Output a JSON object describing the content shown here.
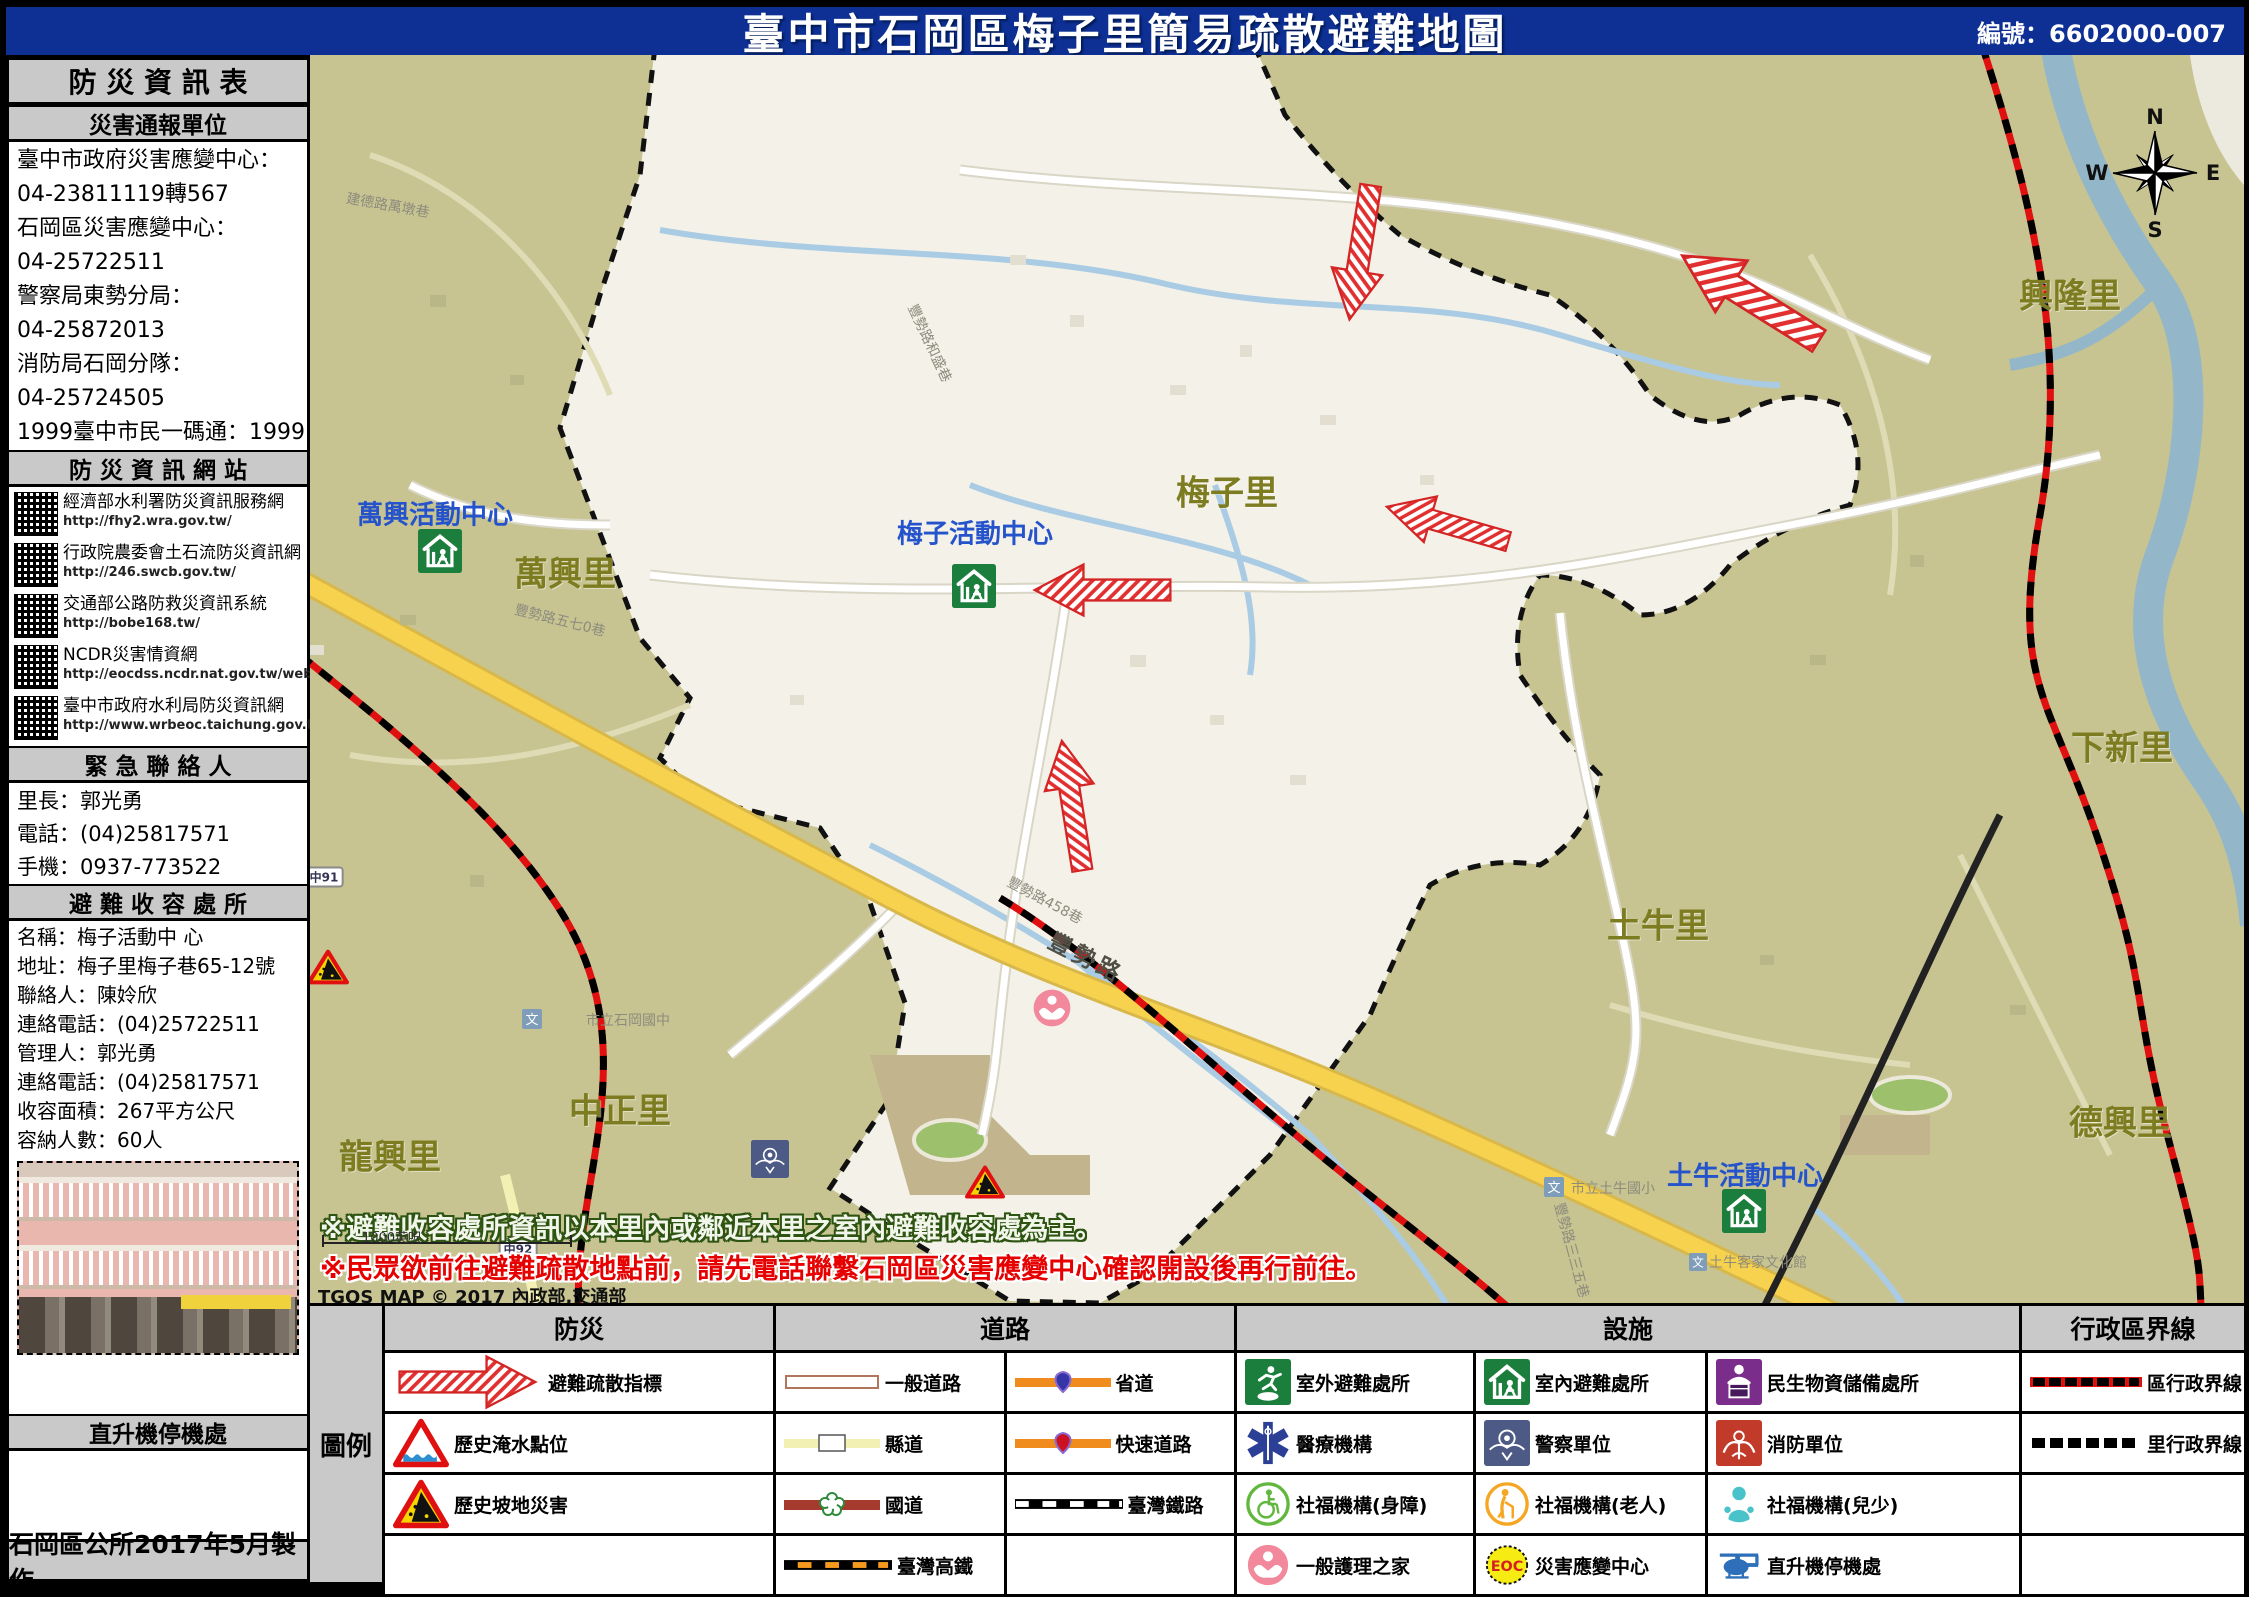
{
  "header": {
    "title": "臺中市石岡區梅子里簡易疏散避難地圖",
    "code": "編號：6602000-007"
  },
  "sidebar": {
    "title": "防 災 資 訊 表",
    "report_header": "災害通報單位",
    "report_lines": [
      {
        "t": "臺中市政府災害應變中心："
      },
      {
        "t": "04-23811119轉567"
      },
      {
        "t": "石岡區災害應變中心："
      },
      {
        "t": "04-25722511"
      },
      {
        "t": "警察局東勢分局："
      },
      {
        "t": "04-25872013"
      },
      {
        "t": "消防局石岡分隊："
      },
      {
        "t": "04-25724505"
      },
      {
        "t": "1999臺中市民一碼通：1999"
      }
    ],
    "web_header": "防 災 資 訊 網 站",
    "websites": [
      {
        "name": "經濟部水利署防災資訊服務網",
        "url": "http://fhy2.wra.gov.tw/"
      },
      {
        "name": "行政院農委會土石流防災資訊網",
        "url": "http://246.swcb.gov.tw/"
      },
      {
        "name": "交通部公路防救災資訊系統",
        "url": "http://bobe168.tw/"
      },
      {
        "name": "NCDR災害情資網",
        "url": "http://eocdss.ncdr.nat.gov.tw/web/"
      },
      {
        "name": "臺中市政府水利局防災資訊網",
        "url": "http://www.wrbeoc.taichung.gov.tw/"
      }
    ],
    "contact_header": "緊 急 聯 絡 人",
    "contact_lines": [
      {
        "t": "里長：郭光勇"
      },
      {
        "t": "電話：(04)25817571"
      },
      {
        "t": "手機：0937-773522"
      }
    ],
    "shelter_header": "避 難 收 容 處 所",
    "shelter_lines": [
      {
        "t": "名稱：梅子活動中 心"
      },
      {
        "t": "地址：梅子里梅子巷65-12號"
      },
      {
        "t": "聯絡人：陳姈欣"
      },
      {
        "t": "連絡電話：(04)25722511"
      },
      {
        "t": "管理人：郭光勇"
      },
      {
        "t": "連絡電話：(04)25817571"
      },
      {
        "t": "收容面積：267平方公尺"
      },
      {
        "t": "容納人數：60人"
      }
    ],
    "heliport_header": "直升機停機處",
    "footer": "石岡區公所2017年5月製作"
  },
  "map": {
    "notes": {
      "note1": "※避難收容處所資訊以本里內或鄰近本里之室內避難收容處為主。",
      "note2": "※民眾欲前往避難疏散地點前，請先電話聯繫石岡區災害應變中心確認開設後再行前往。",
      "credit": "TGOS MAP © 2017 內政部,交通部",
      "scale": "1000英呎"
    },
    "compass": [
      {
        "t": "N",
        "x": 1845,
        "y": 62
      },
      {
        "t": "E",
        "x": 1903,
        "y": 118
      },
      {
        "t": "S",
        "x": 1845,
        "y": 175
      },
      {
        "t": "W",
        "x": 1787,
        "y": 118
      }
    ],
    "labels": [
      {
        "text": "興隆里",
        "x": 1760,
        "y": 238,
        "cls": "lbl-village"
      },
      {
        "text": "下新里",
        "x": 1812,
        "y": 690,
        "cls": "lbl-village"
      },
      {
        "text": "德興里",
        "x": 1810,
        "y": 1065,
        "cls": "lbl-village"
      },
      {
        "text": "土牛里",
        "x": 1348,
        "y": 868,
        "cls": "lbl-village"
      },
      {
        "text": "梅子里",
        "x": 917,
        "y": 435,
        "cls": "lbl-village"
      },
      {
        "text": "萬興里",
        "x": 255,
        "y": 516,
        "cls": "lbl-village"
      },
      {
        "text": "中正里",
        "x": 310,
        "y": 1053,
        "cls": "lbl-village"
      },
      {
        "text": "龍興里",
        "x": 80,
        "y": 1099,
        "cls": "lbl-village"
      },
      {
        "text": "萬興活動中心",
        "x": 125,
        "y": 458,
        "cls": "lbl-shelter"
      },
      {
        "text": "梅子活動中心",
        "x": 665,
        "y": 477,
        "cls": "lbl-shelter"
      },
      {
        "text": "土牛活動中心",
        "x": 1435,
        "y": 1119,
        "cls": "lbl-shelter"
      },
      {
        "text": "豐勢路",
        "x": 777,
        "y": 901,
        "cls": "lbl-road",
        "rot": "27deg"
      },
      {
        "text": "市立石岡國中",
        "x": 318,
        "y": 965,
        "cls": "lbl-small"
      },
      {
        "text": "市立土牛國小",
        "x": 1303,
        "y": 1133,
        "cls": "lbl-small"
      },
      {
        "text": "土牛客家文化館",
        "x": 1448,
        "y": 1207,
        "cls": "lbl-small"
      },
      {
        "text": "豐勢路458巷",
        "x": 735,
        "y": 845,
        "cls": "lbl-small",
        "rot": "28deg"
      },
      {
        "text": "豐勢路五七0巷",
        "x": 250,
        "y": 565,
        "cls": "lbl-small",
        "rot": "14deg"
      },
      {
        "text": "豐勢路三三五巷",
        "x": 1262,
        "y": 1195,
        "cls": "lbl-small",
        "rot": "75deg"
      },
      {
        "text": "建德路萬墩巷",
        "x": 78,
        "y": 150,
        "cls": "lbl-small",
        "rot": "10deg"
      },
      {
        "text": "豐勢路和盛巷",
        "x": 620,
        "y": 288,
        "cls": "lbl-small",
        "rot": "65deg"
      }
    ],
    "icons": [
      {
        "icon": "sym-fac-indoor",
        "x": 130,
        "y": 496,
        "w": 44,
        "h": 44
      },
      {
        "icon": "sym-fac-indoor",
        "x": 664,
        "y": 531,
        "w": 44,
        "h": 44
      },
      {
        "icon": "sym-fac-indoor",
        "x": 1434,
        "y": 1156,
        "w": 44,
        "h": 44
      },
      {
        "icon": "sym-slope",
        "x": 18,
        "y": 912,
        "w": 42,
        "h": 40
      },
      {
        "icon": "sym-slope",
        "x": 675,
        "y": 1127,
        "w": 40,
        "h": 38
      },
      {
        "icon": "sym-fac-nursing",
        "x": 742,
        "y": 953,
        "w": 42,
        "h": 42
      },
      {
        "icon": "sym-fac-police",
        "x": 460,
        "y": 1104,
        "w": 38,
        "h": 38
      },
      {
        "icon": "sym-school",
        "x": 222,
        "y": 964,
        "w": 20,
        "h": 20
      },
      {
        "icon": "sym-school",
        "x": 1244,
        "y": 1132,
        "w": 20,
        "h": 20
      },
      {
        "icon": "sym-school",
        "x": 1388,
        "y": 1207,
        "w": 18,
        "h": 18
      }
    ],
    "arrows": [
      {
        "x": 1050,
        "y": 198,
        "w": 140,
        "h": 58,
        "rot": "99deg"
      },
      {
        "x": 1440,
        "y": 243,
        "w": 165,
        "h": 69,
        "rot": "212deg"
      },
      {
        "x": 1137,
        "y": 469,
        "w": 130,
        "h": 54,
        "rot": "196deg"
      },
      {
        "x": 792,
        "y": 535,
        "w": 140,
        "h": 58,
        "rot": "180deg"
      },
      {
        "x": 762,
        "y": 750,
        "w": 135,
        "h": 56,
        "rot": "261deg"
      }
    ],
    "shields": [
      {
        "text": "中91",
        "x": 14,
        "y": 822
      },
      {
        "text": "中92",
        "x": 208,
        "y": 1194
      }
    ]
  },
  "legend": {
    "title": "圖例",
    "headers": [
      {
        "t": "防災"
      },
      {
        "t": "道路"
      },
      {
        "t": "設施"
      },
      {
        "t": "行政區界線"
      }
    ],
    "disaster": [
      {
        "icon": "sym-arrow",
        "label": "避難疏散指標",
        "w": 150,
        "h": 58
      },
      {
        "icon": "sym-flood",
        "label": "歷史淹水點位",
        "w": 56,
        "h": 52
      },
      {
        "icon": "sym-slope",
        "label": "歷史坡地災害",
        "w": 56,
        "h": 52
      },
      {
        "icon": "",
        "label": "",
        "w": 10,
        "h": 10
      }
    ],
    "roads": [
      {
        "icon": "sym-road-general",
        "label": "一般道路",
        "w": 96,
        "h": 22
      },
      {
        "icon": "sym-road-provincial",
        "label": "省道",
        "w": 96,
        "h": 26
      },
      {
        "icon": "sym-road-county",
        "label": "縣道",
        "w": 96,
        "h": 24
      },
      {
        "icon": "sym-road-expressway",
        "label": "快速道路",
        "w": 96,
        "h": 26
      },
      {
        "icon": "sym-road-national",
        "label": "國道",
        "w": 96,
        "h": 26
      },
      {
        "icon": "sym-rail-tra",
        "label": "臺灣鐵路",
        "w": 108,
        "h": 16
      },
      {
        "icon": "sym-rail-hsr",
        "label": "臺灣高鐵",
        "w": 108,
        "h": 16
      },
      {
        "icon": "",
        "label": "",
        "w": 10,
        "h": 10
      }
    ],
    "facilities": [
      {
        "icon": "sym-fac-outdoor",
        "label": "室外避難處所",
        "w": 46,
        "h": 46
      },
      {
        "icon": "sym-fac-indoor",
        "label": "室內避難處所",
        "w": 46,
        "h": 46
      },
      {
        "icon": "sym-fac-supplies",
        "label": "民生物資儲備處所",
        "w": 46,
        "h": 46
      },
      {
        "icon": "sym-fac-medical",
        "label": "醫療機構",
        "w": 46,
        "h": 46
      },
      {
        "icon": "sym-fac-police",
        "label": "警察單位",
        "w": 46,
        "h": 46
      },
      {
        "icon": "sym-fac-fire",
        "label": "消防單位",
        "w": 46,
        "h": 46
      },
      {
        "icon": "sym-fac-disabled",
        "label": "社福機構(身障)",
        "w": 46,
        "h": 46
      },
      {
        "icon": "sym-fac-elderly",
        "label": "社福機構(老人)",
        "w": 46,
        "h": 46
      },
      {
        "icon": "sym-fac-child",
        "label": "社福機構(兒少)",
        "w": 46,
        "h": 46
      },
      {
        "icon": "sym-fac-nursing",
        "label": "一般護理之家",
        "w": 46,
        "h": 46
      },
      {
        "icon": "sym-fac-eoc",
        "label": "災害應變中心",
        "w": 46,
        "h": 46
      },
      {
        "icon": "sym-fac-heliport",
        "label": "直升機停機處",
        "w": 46,
        "h": 46
      }
    ],
    "admin": [
      {
        "icon": "sym-line-district",
        "label": "區行政界線",
        "w": 112,
        "h": 20
      },
      {
        "icon": "sym-line-village",
        "label": "里行政界線",
        "w": 112,
        "h": 20
      },
      {
        "icon": "",
        "label": "",
        "w": 10,
        "h": 10
      },
      {
        "icon": "",
        "label": "",
        "w": 10,
        "h": 10
      }
    ]
  }
}
